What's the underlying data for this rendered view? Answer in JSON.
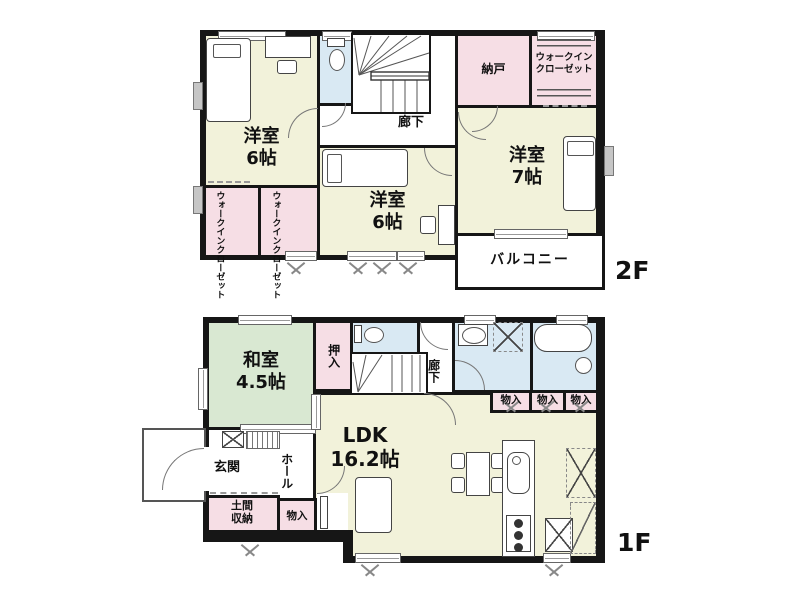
{
  "colors": {
    "wall": "#161616",
    "western_room": "#f2f2da",
    "japanese_room": "#d9e8d2",
    "storage": "#f6dee5",
    "wet_area": "#d9e9f3"
  },
  "floor2": {
    "label": "2F",
    "bedroomA": {
      "name": "洋室",
      "size": "6帖"
    },
    "bedroomB": {
      "name": "洋室",
      "size": "6帖"
    },
    "bedroomC": {
      "name": "洋室",
      "size": "7帖"
    },
    "nando": "納戸",
    "wic": {
      "line1": "ウォークイン",
      "line2": "クローゼット"
    },
    "hallway": "廊下",
    "balcony": "バルコニー"
  },
  "floor1": {
    "label": "1F",
    "washitsu": {
      "name": "和室",
      "size": "4.5帖"
    },
    "oshiire": "押入",
    "hallway": "廊下",
    "ldk": {
      "name": "LDK",
      "size": "16.2帖"
    },
    "genkan": "玄関",
    "hall": "ホール",
    "doma": {
      "line1": "土間",
      "line2": "収納"
    },
    "monoire": "物入",
    "storage_row": [
      "物入",
      "物入",
      "物入"
    ]
  }
}
